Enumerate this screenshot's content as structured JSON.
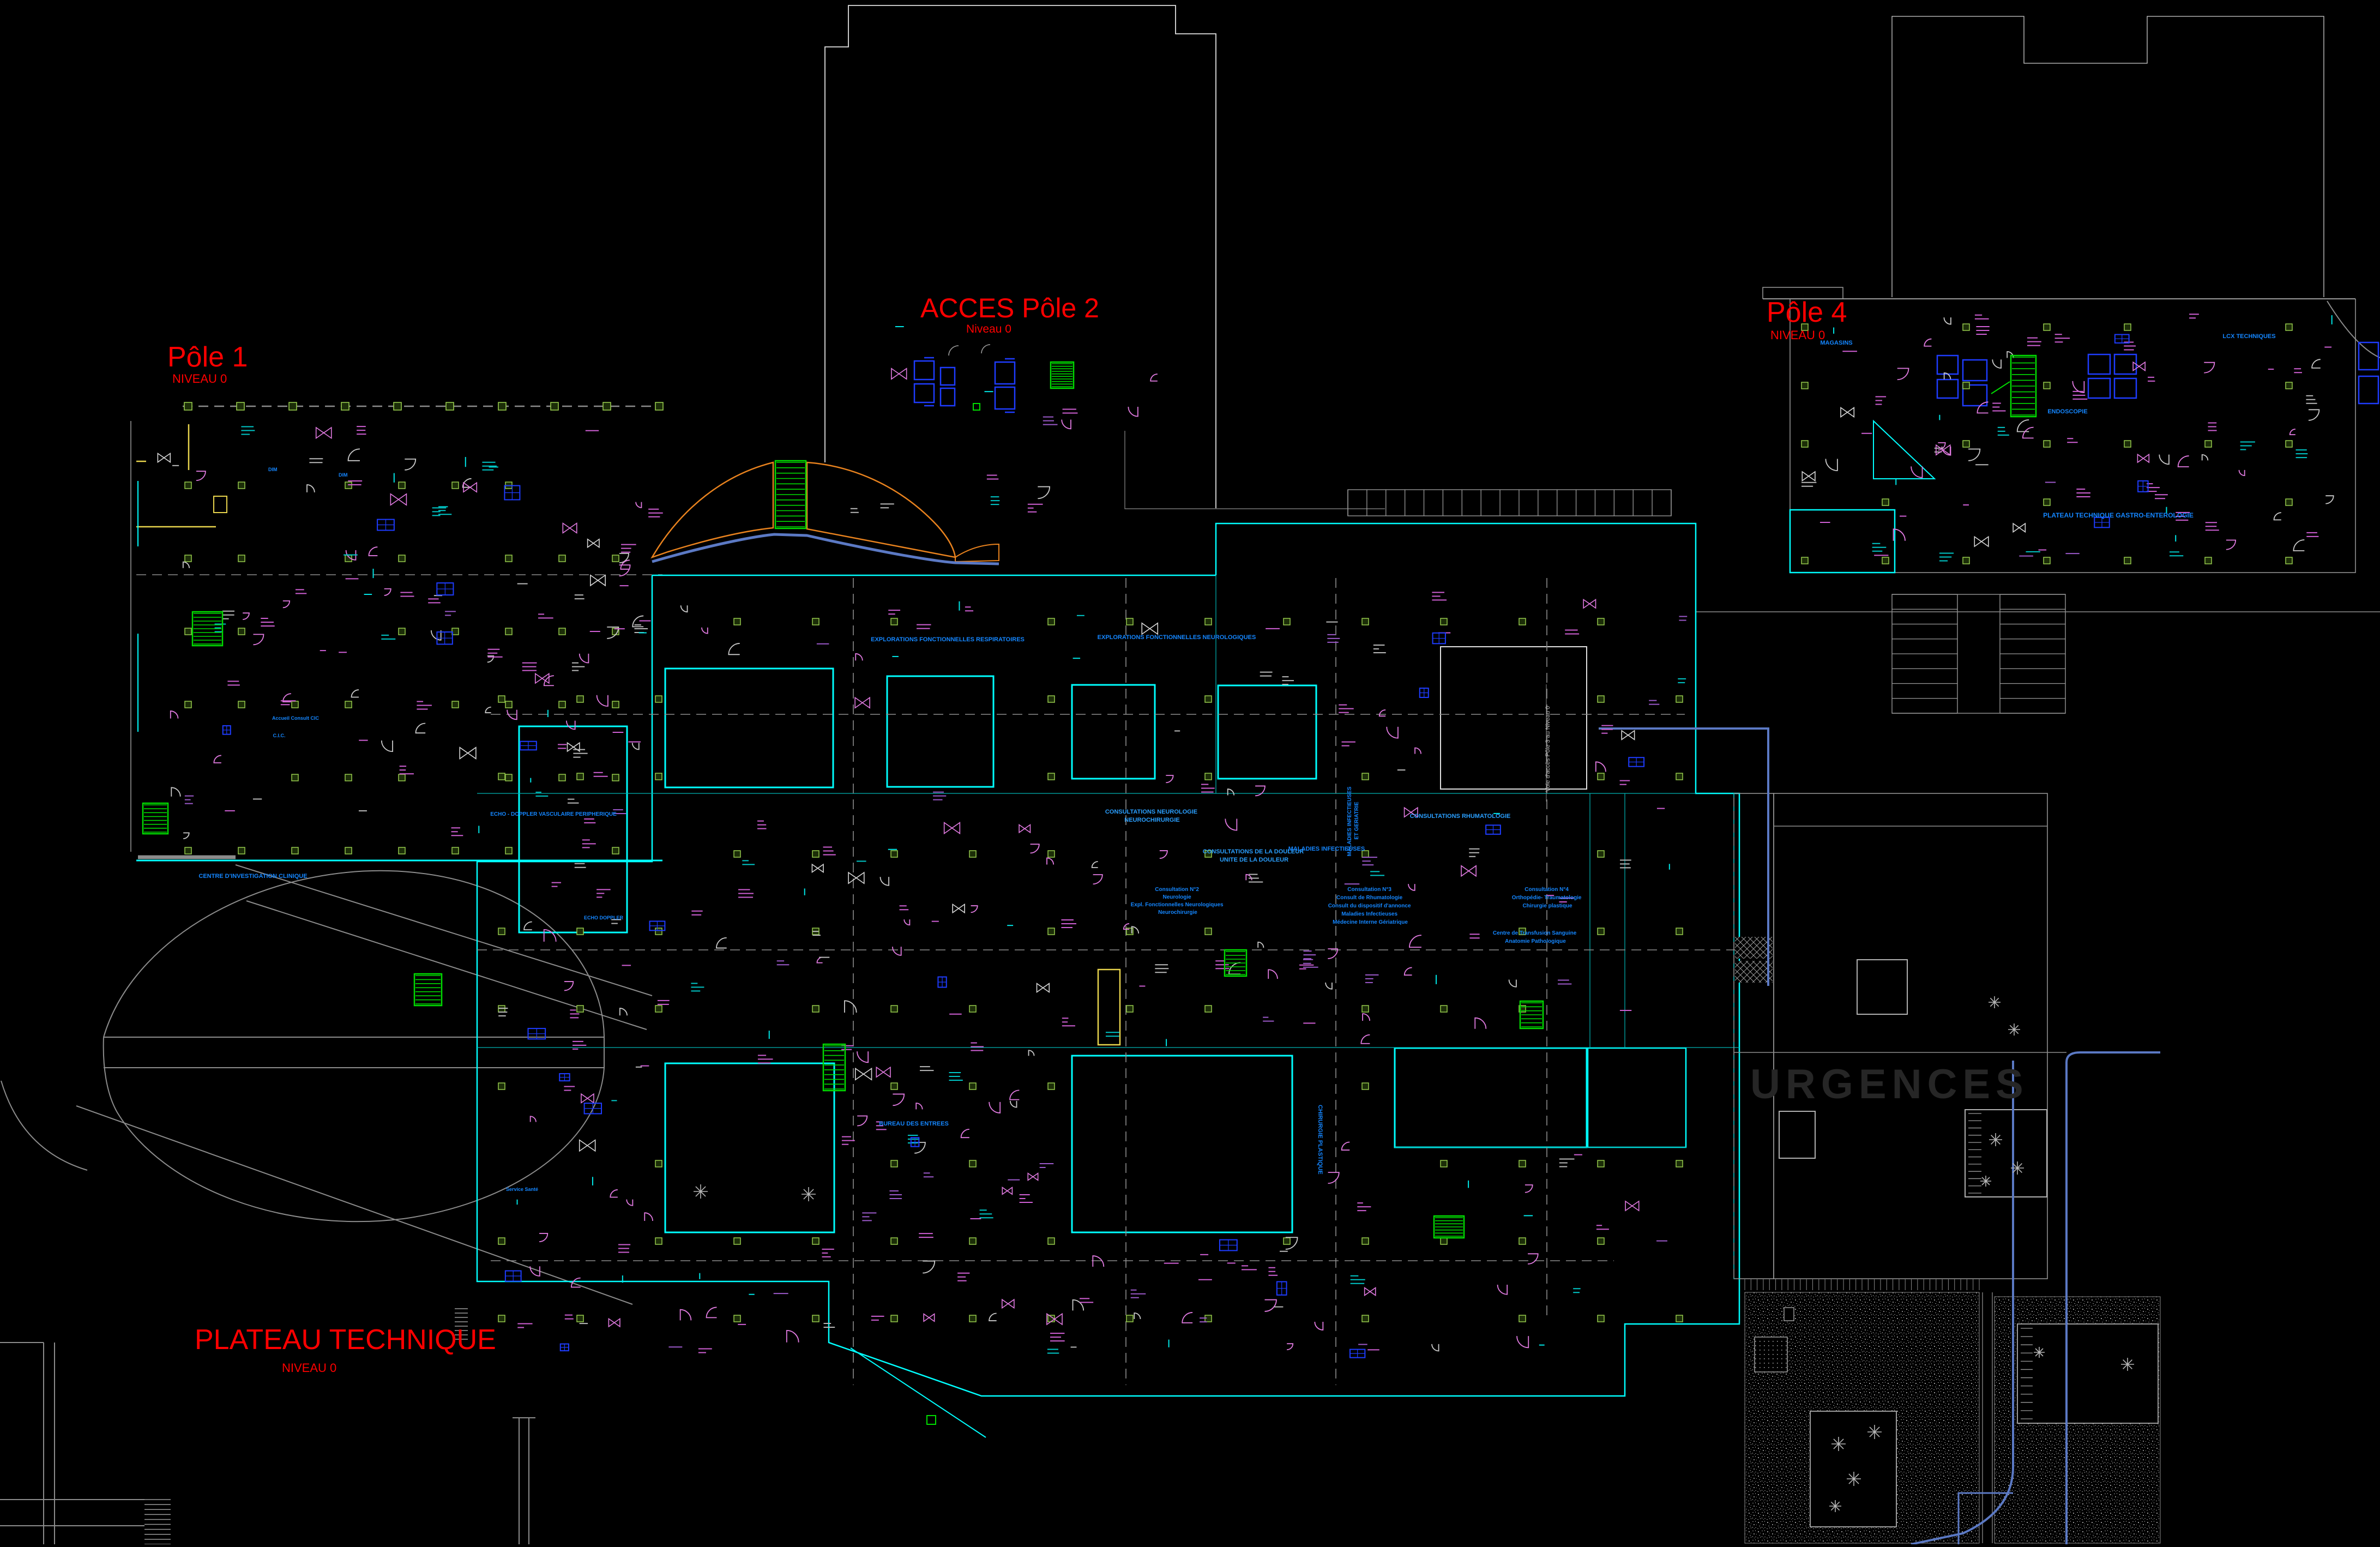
{
  "page": {
    "background": "#000000",
    "description": "CAD site / floor plan, hospital campus, level 0"
  },
  "zones": {
    "pole1": {
      "title": "Pôle 1",
      "subtitle": "NIVEAU 0"
    },
    "acces_pole2": {
      "title": "ACCES Pôle 2",
      "subtitle": "Niveau 0"
    },
    "pole4": {
      "title": "Pôle 4",
      "subtitle": "NIVEAU 0"
    },
    "plateau_technique": {
      "title": "PLATEAU TECHNIQUE",
      "subtitle": "NIVEAU 0"
    },
    "urgences": {
      "title": "URGENCES"
    }
  },
  "department_labels": {
    "consult_neuro": {
      "lines": [
        "CONSULTATIONS NEUROLOGIE",
        "NEUROCHIRURGIE"
      ]
    },
    "douleur": {
      "lines": [
        "CONSULTATIONS DE LA DOULEUR",
        "UNITE DE LA DOULEUR"
      ]
    },
    "maladies_infectieuses": {
      "text": "MALADIES INFECTIEUSES"
    },
    "maladies_geriatrie": {
      "lines": [
        "MALADIES INFECTIEUSES",
        "ET GERIATRIE"
      ]
    },
    "rhumatologie": {
      "text": "CONSULTATIONS  RHUMATOLOGIE"
    },
    "explorations_respiratoires": {
      "text": "EXPLORATIONS FONCTIONNELLES RESPIRATOIRES"
    },
    "explorations_neurologiques": {
      "text": "EXPLORATIONS FONCTIONNELLES NEUROLOGIQUES"
    },
    "consultation2": {
      "lines": [
        "Consultation N°2",
        "Neurologie",
        "Expl. Fonctionnelles Neurologiques",
        "Neurochirurgie"
      ]
    },
    "consultation3": {
      "lines": [
        "Consultation N°3",
        "Consult de Rhumatologie",
        "Consult du dispositif d'annonce",
        "Maladies Infectieuses",
        "Médecine Interne Gériatrique"
      ]
    },
    "consultation4": {
      "lines": [
        "Consultation N°4",
        "Orthopédie- Traumatologie",
        "Chirurgie plastique"
      ]
    },
    "transfusion": {
      "lines": [
        "Centre de Transfusion Sanguine",
        "Anatomie Pathologique"
      ]
    },
    "bureau_entrees": {
      "text": "BUREAU DES ENTREES"
    },
    "chirurgie_plastique": {
      "text": "CHIRURGIE PLASTIQUE"
    },
    "cic": {
      "text": "CENTRE D'INVESTIGATION CLINIQUE"
    },
    "accueil_cic": {
      "text": "Accueil Consult CIC"
    },
    "cic_short": {
      "text": "C.I.C."
    },
    "dim": {
      "text": "DIM"
    },
    "echo_doppler_vasculaire": {
      "text": "ECHO - DOPPLER VASCULAIRE PERIPHERIQUE"
    },
    "echo_doppler": {
      "text": "ECHO DOPPLER"
    },
    "plateau_gastro": {
      "text": "PLATEAU TECHNIQUE GASTRO-ENTEROLOGIE"
    },
    "lcx_techniques": {
      "text": "LCX TECHNIQUES"
    },
    "endoscopie": {
      "text": "ENDOSCOPIE"
    },
    "magasins": {
      "text": "MAGASINS"
    },
    "voie_acces": {
      "text": "Voie d'accès Pôle 3 au Niveau 0"
    },
    "service_sante": {
      "text": "Service Santé"
    }
  },
  "colors": {
    "background": "#000000",
    "walls_cyan": "#00ffff",
    "walls_white": "#e0e0e0",
    "roads_gray": "#8c8c8c",
    "road_blue": "#5b79c4",
    "titles_red": "#ff0000",
    "labels_blue": "#1486ff",
    "doors_magenta": "#e07ae0",
    "furniture_blue": "#1e3cff",
    "stairs_green": "#00dd00",
    "columns_olive": "#95c94c",
    "ramp_orange": "#e8821e",
    "accent_yellow": "#e8d44d"
  }
}
